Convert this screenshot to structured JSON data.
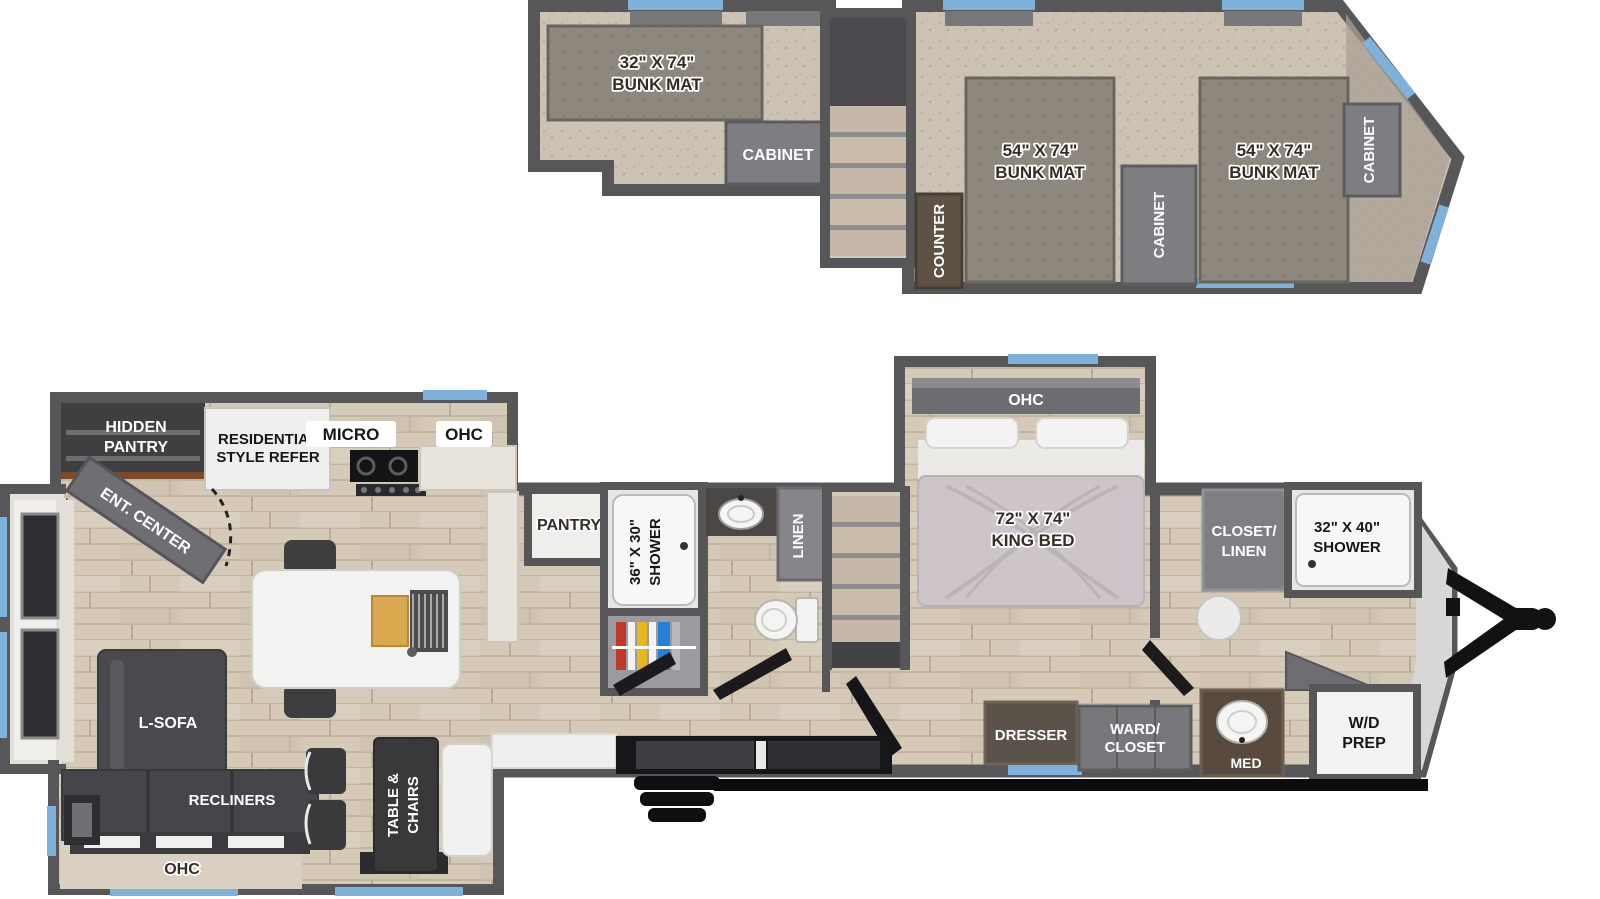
{
  "plan": {
    "type": "rv-destination-trailer-floorplan",
    "levels": [
      "loft",
      "main floor"
    ]
  },
  "colors": {
    "wall": "#57575a",
    "wood_floor": "#d5cab8",
    "carpet": "#cdc3b5",
    "bunk_mat": "#8d877e",
    "window_blue": "#7fb2da",
    "furniture_dark": "#46464a",
    "fixture_white": "#f4f3f1",
    "cabinet_gray": "#7e7e82",
    "counter_brown": "#5e5246",
    "hitch_black": "#121214"
  },
  "loft": {
    "bunk_small_line1": "32\" X 74\"",
    "bunk_small_line2": "BUNK MAT",
    "cabinet_rear": "CABINET",
    "bunk_large_line1": "54\" X 74\"",
    "bunk_large_line2": "BUNK MAT",
    "cabinet_mid": "CABINET",
    "cabinet_front": "CABINET",
    "counter": "COUNTER"
  },
  "main_floor": {
    "hidden_pantry_line1": "HIDDEN",
    "hidden_pantry_line2": "PANTRY",
    "refer_line1": "RESIDENTIAL",
    "refer_line2": "STYLE REFER",
    "micro": "MICRO",
    "ohc_kitchen": "OHC",
    "ent_center": "ENT. CENTER",
    "pantry": "PANTRY",
    "shower36_line1": "36\" X 30\"",
    "shower36_line2": "SHOWER",
    "linen": "LINEN",
    "king_line1": "72\" X 74\"",
    "king_line2": "KING BED",
    "ohc_bedroom": "OHC",
    "closet_linen_line1": "CLOSET/",
    "closet_linen_line2": "LINEN",
    "shower32_line1": "32\" X 40\"",
    "shower32_line2": "SHOWER",
    "l_sofa": "L-SOFA",
    "recliners": "RECLINERS",
    "ohc_living": "OHC",
    "table_line1": "TABLE &",
    "table_line2": "CHAIRS",
    "dresser": "DRESSER",
    "ward_line1": "WARD/",
    "ward_line2": "CLOSET",
    "med": "MED",
    "wd_line1": "W/D",
    "wd_line2": "PREP"
  }
}
